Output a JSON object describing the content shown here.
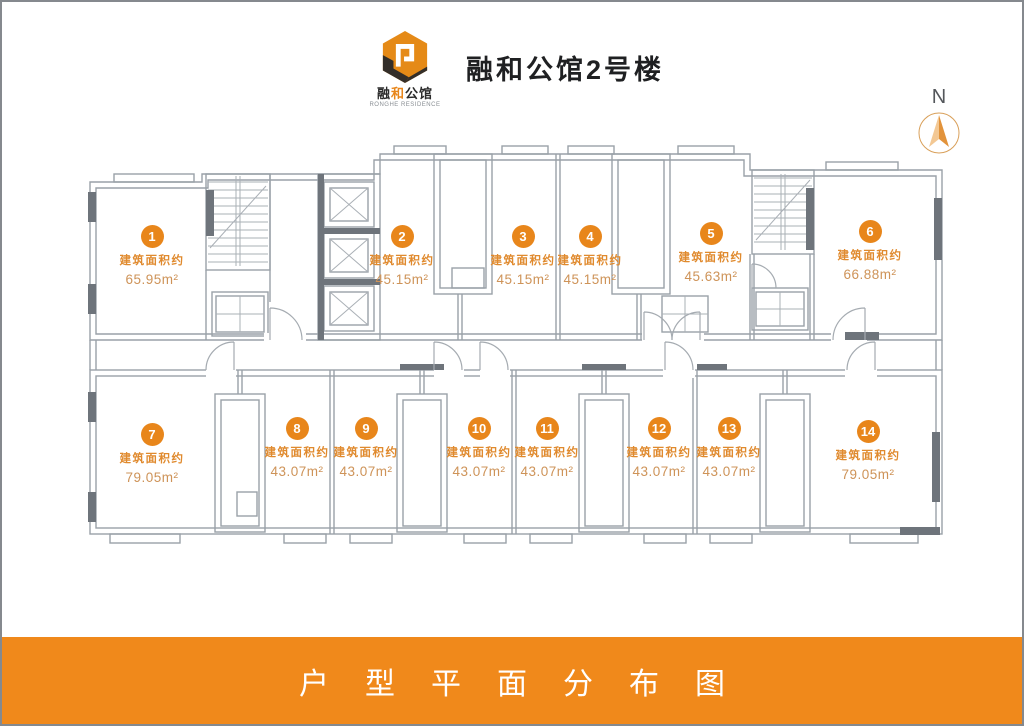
{
  "header": {
    "title": "融和公馆2号楼"
  },
  "brand": {
    "logo_text_p1": "融",
    "logo_text_p2": "和",
    "logo_text_p3": "公馆",
    "logo_subtext": "RONGHE RESIDENCE"
  },
  "north": {
    "label": "N"
  },
  "labels": {
    "area_caption": "建筑面积约"
  },
  "units": [
    {
      "number": "1",
      "area": "65.95m²"
    },
    {
      "number": "2",
      "area": "45.15m²"
    },
    {
      "number": "3",
      "area": "45.15m²"
    },
    {
      "number": "4",
      "area": "45.15m²"
    },
    {
      "number": "5",
      "area": "45.63m²"
    },
    {
      "number": "6",
      "area": "66.88m²"
    },
    {
      "number": "7",
      "area": "79.05m²"
    },
    {
      "number": "8",
      "area": "43.07m²"
    },
    {
      "number": "9",
      "area": "43.07m²"
    },
    {
      "number": "10",
      "area": "43.07m²"
    },
    {
      "number": "11",
      "area": "43.07m²"
    },
    {
      "number": "12",
      "area": "43.07m²"
    },
    {
      "number": "13",
      "area": "43.07m²"
    },
    {
      "number": "14",
      "area": "79.05m²"
    }
  ],
  "footer": {
    "title": "户型平面分布图"
  },
  "colors": {
    "accent": "#E8861B",
    "caption": "#E08A2E",
    "area_value": "#CE9358",
    "banner": "#F0891B",
    "wall": "#9AA1A8",
    "wall_dark": "#6E747B"
  }
}
